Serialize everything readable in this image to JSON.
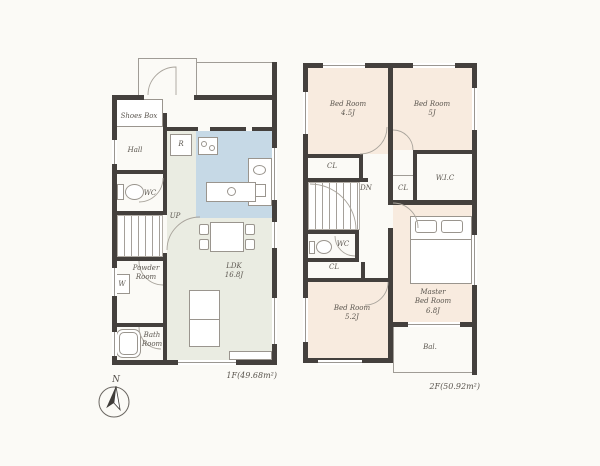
{
  "floor1": {
    "area_label": "1F(49.68m²)",
    "labels": {
      "shoes_box": "Shoes Box",
      "hall": "Hall",
      "wc": "WC",
      "up": "UP",
      "washer": "W",
      "powder_room": "Powder\nRoom",
      "bath_room": "Bath\nRoom",
      "fridge": "R",
      "ldk": "LDK\n16.8J"
    }
  },
  "floor2": {
    "area_label": "2F(50.92m²)",
    "labels": {
      "bedroom1": "Bed Room\n4.5J",
      "bedroom2": "Bed Room\n5J",
      "closet1": "CL",
      "down": "DN",
      "wc": "WC",
      "closet2": "CL",
      "closet3": "CL",
      "wic": "W.I.C",
      "bedroom3": "Bed Room\n5.2J",
      "master_bedroom": "Master\nBed Room\n6.8J",
      "balcony": "Bal."
    }
  },
  "compass": {
    "north": "N"
  },
  "colors": {
    "wall": "#44403d",
    "ldk_floor": "#eaece2",
    "kitchen_floor": "#c6d9e6",
    "bedroom_floor": "#f8ebdf",
    "background": "#fbfaf6"
  }
}
